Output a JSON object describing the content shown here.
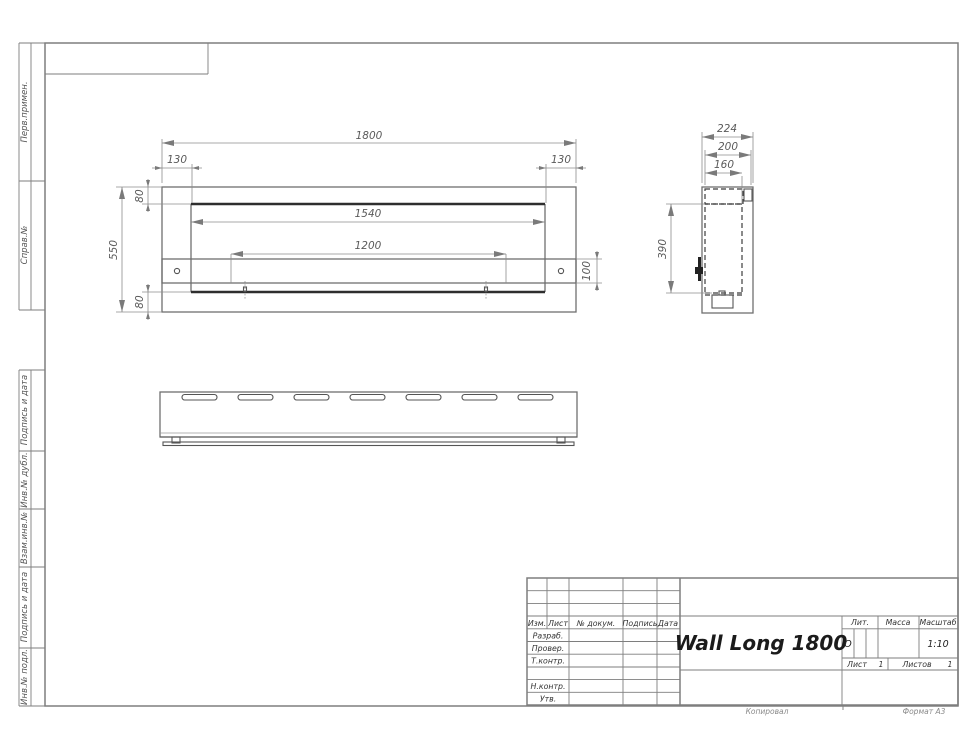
{
  "sheet": {
    "side_labels": {
      "perv": "Перв.примен.",
      "sprav": "Справ.№",
      "podpis1": "Подпись и дата",
      "inv_dubl": "Инв.№ дубл.",
      "vzam": "Взам.инв.№",
      "podpis2": "Подпись и дата",
      "inv_podl": "Инв.№ подл."
    },
    "footer": {
      "copied": "Копировал",
      "format": "Формат А3"
    }
  },
  "front_view": {
    "dims": {
      "overall_width": "1800",
      "offset_left": "130",
      "offset_right": "130",
      "offset_top": "80",
      "opening_width": "1540",
      "bracket_span": "1200",
      "bracket_height": "100",
      "offset_bottom": "80",
      "overall_height": "550"
    }
  },
  "side_view": {
    "dims": {
      "overall_depth": "224",
      "body_depth": "200",
      "inner_depth": "160",
      "inner_height": "390"
    }
  },
  "title_block": {
    "rev_header": {
      "izm": "Изм.",
      "list": "Лист",
      "doc": "№ докум.",
      "sign": "Подпись",
      "date": "Дата"
    },
    "roles": {
      "razrab": "Разраб.",
      "prover": "Провер.",
      "tkontr": "Т.контр.",
      "nkontr": "Н.контр.",
      "utv": "Утв."
    },
    "title": "Wall Long 1800",
    "lit": {
      "label": "Лит.",
      "value": "О"
    },
    "mass": {
      "label": "Масса",
      "value": ""
    },
    "scale": {
      "label": "Масштаб",
      "value": "1:10"
    },
    "sheet_no": {
      "label": "Лист",
      "value": "1"
    },
    "sheets_total": {
      "label": "Листов",
      "value": "1"
    }
  }
}
